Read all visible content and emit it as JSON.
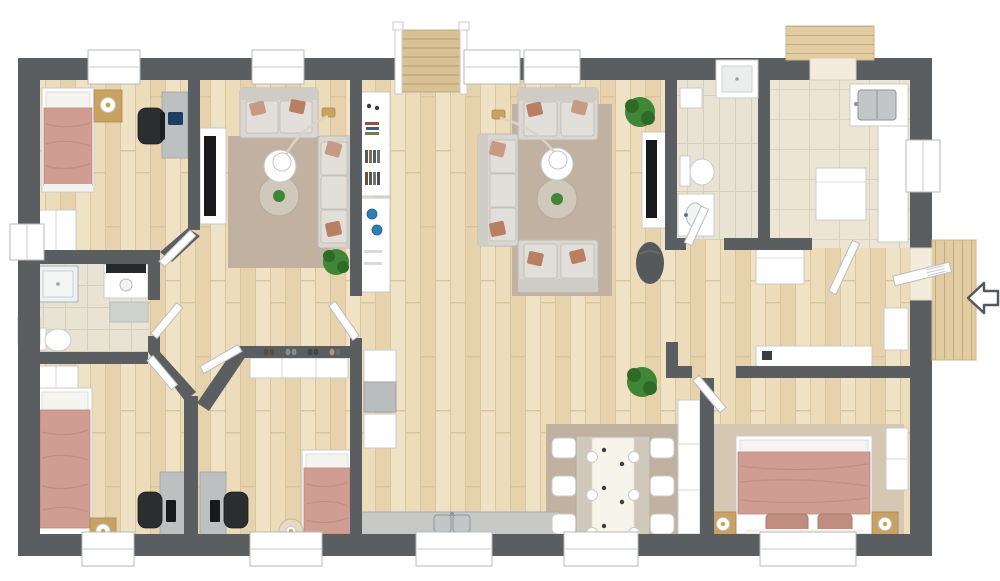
{
  "meta": {
    "view": "3d-rendered floor plan, overhead top-down view, no text labels visible",
    "building": "single-storey residence with central great room, staircase at top, entry door on right with direction arrow"
  },
  "colors": {
    "wall": "#5a5e61",
    "wood1": "#ecdcba",
    "wood2": "#e6d3ad",
    "wood3": "#f0e2c4",
    "woodline": "#d8c49d",
    "tile": "#e9e3d4",
    "tileline": "#d6cfbd",
    "bigtile": "#ece5d3",
    "bigtileline": "#d9d2be",
    "rugwarm": "#c1b1a0",
    "ruglight": "#d5c7b1",
    "sofa": "#dad7d2",
    "sofaline": "#bdb9b2",
    "cushion": "#e2dfda",
    "pillowrust": "#b97f63",
    "pillowsalmon": "#c79a83",
    "blanket": "#cf9d92",
    "blanketline": "#b98a7e",
    "white": "#ffffff",
    "furnstroke": "#c9cbc9",
    "woodfurn": "#c9a263",
    "deskgray": "#bcc0c0",
    "tvblack": "#17191c",
    "chairblack": "#2b2d2f",
    "plant": "#3f8636",
    "plantdark": "#2f6b28",
    "steel": "#c2c6c9",
    "steeldark": "#8f9598",
    "deck": "#e2cda2",
    "deckline": "#c3aa7e",
    "gold": "#c9a24a",
    "blue": "#2f7fb5",
    "countergray": "#c6c9c6",
    "darkseat": "#55595c",
    "glassblue": "#eef1f2",
    "mat": "#cfd2cd"
  },
  "entry": {
    "arrow_direction": "left",
    "location": "right wall, opens onto wood deck"
  },
  "exterior": {
    "decks": [
      "top-right-deck",
      "right-entry-deck"
    ],
    "staircase": "top-center, descends into great room"
  },
  "rooms": [
    {
      "name": "bedroom-top-left",
      "furniture": [
        "single-bed-salmon-blanket",
        "nightstand-with-lamp",
        "desk-with-laptop",
        "office-chair",
        "wardrobe",
        "window-top",
        "window-left"
      ]
    },
    {
      "name": "living-room-left",
      "furniture": [
        "loveseat-top",
        "sofa-right",
        "area-rug",
        "round-white-table",
        "round-wood-table-with-plant",
        "arc-floor-lamp",
        "tv-panel",
        "potted-plant",
        "accent-pillows"
      ]
    },
    {
      "name": "hall-shelving",
      "furniture": [
        "bookshelf-with-decor",
        "white-sideboard-with-blue-plates"
      ]
    },
    {
      "name": "bathroom-left",
      "furniture": [
        "glass-shower",
        "vanity-with-dark-counter",
        "bath-mat",
        "toilet",
        "small-wall-sink"
      ]
    },
    {
      "name": "bedroom-bottom-left",
      "furniture": [
        "single-bed-salmon-blanket",
        "nightstand-with-lamp",
        "wardrobe",
        "desk-with-monitor",
        "office-chair",
        "window-bottom"
      ]
    },
    {
      "name": "bedroom-bottom-middle",
      "furniture": [
        "single-bed-salmon-blanket",
        "round-stool-with-lamp",
        "desk-with-monitor",
        "office-chair",
        "dresser",
        "decor-items-on-half-wall"
      ]
    },
    {
      "name": "kitchen-bottom",
      "furniture": [
        "fridge",
        "tall-cabinet",
        "counter-run-gray-top",
        "double-stainless-sink",
        "window-above-sink"
      ]
    },
    {
      "name": "great-room",
      "furniture": [
        "staircase-with-railings",
        "potted-plant",
        "white-console"
      ]
    },
    {
      "name": "living-room-center",
      "furniture": [
        "loveseat-top",
        "sofa-left",
        "loveseat-bottom",
        "area-rug",
        "round-white-table",
        "round-wood-table-with-plant",
        "arc-floor-lamp",
        "tv-panel",
        "potted-plant",
        "dark-pouf-chair",
        "two-windows-top"
      ]
    },
    {
      "name": "bathroom-center",
      "furniture": [
        "shower-enclosure-top",
        "toilet",
        "vanity-sink",
        "wall-cabinet",
        "striped-tile-floor"
      ]
    },
    {
      "name": "kitchen-top-right",
      "furniture": [
        "sink-counter-with-steel-sink",
        "side-counter",
        "island",
        "peninsula",
        "big-tile-floor",
        "deck-door-top"
      ]
    },
    {
      "name": "entry-hall",
      "furniture": [
        "open-entry-door",
        "entry-bench",
        "sideboard-console",
        "deck-outside",
        "white-direction-arrow"
      ]
    },
    {
      "name": "dining-room",
      "furniture": [
        "table-with-white-runner",
        "six-white-chairs",
        "six-place-settings",
        "area-rug",
        "window-bottom",
        "tall-white-closet"
      ]
    },
    {
      "name": "bedroom-master",
      "furniture": [
        "double-bed-salmon-blanket",
        "two-nightstands-with-lamps",
        "two-pillows",
        "area-rug",
        "closet-right",
        "door-open-top-left",
        "window-bottom"
      ]
    }
  ]
}
